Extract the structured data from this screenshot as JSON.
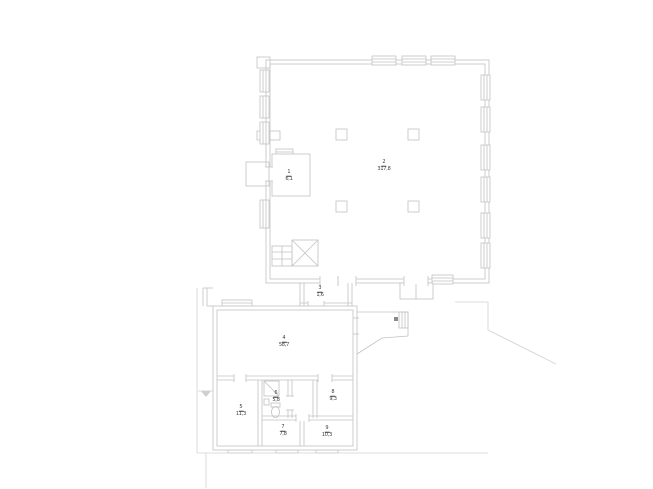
{
  "drawing": {
    "kind_label": "floor-plan",
    "rooms": [
      {
        "number": "1",
        "area": "6,1",
        "name": "entry-room"
      },
      {
        "number": "2",
        "area": "317,8",
        "name": "main-hall"
      },
      {
        "number": "3",
        "area": "1,6",
        "name": "vestibule"
      },
      {
        "number": "4",
        "area": "58,7",
        "name": "lower-main-room"
      },
      {
        "number": "5",
        "area": "11,3",
        "name": "left-room"
      },
      {
        "number": "6",
        "area": "5,8",
        "name": "bathroom"
      },
      {
        "number": "7",
        "area": "7,8",
        "name": "bottom-middle-room"
      },
      {
        "number": "8",
        "area": "9,3",
        "name": "right-middle-room"
      },
      {
        "number": "9",
        "area": "10,3",
        "name": "bottom-right-room"
      }
    ],
    "colors": {
      "wall_line": "#c2c2c2",
      "light_line": "#d2d2d2",
      "label_text": "#3c3c3c",
      "background": "#ffffff"
    }
  }
}
